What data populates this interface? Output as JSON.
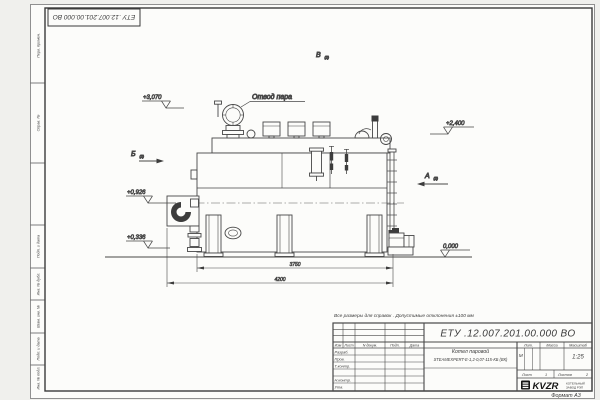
{
  "sheet": {
    "stamp_top_left": "ЕТУ .12.007.201.00.000  ВО",
    "margin_labels": [
      "Перв. примен.",
      "Справ. №",
      "Подп. и дата",
      "Инв. № дубл.",
      "Взам. инв. №",
      "Подп. и дата",
      "Инв. № подл."
    ],
    "format_label": "Формат А3"
  },
  "drawing": {
    "callout_steam": "Отвод пара",
    "views": [
      {
        "letter": "Б",
        "ref": "(2)"
      },
      {
        "letter": "В",
        "ref": "(2)"
      },
      {
        "letter": "А",
        "ref": "(2)"
      }
    ],
    "elevations": [
      "+3,070",
      "+2,400",
      "+0,926",
      "+0,336",
      "0,000"
    ],
    "dims": [
      "3750",
      "4200"
    ]
  },
  "note": "Все размеры для справок . Допустимые отклонения  ±100 мм",
  "title_block": {
    "number": "ЕТУ .12.007.201.00.000  ВО",
    "header_cols": [
      "Изм",
      "Лист",
      "N докум.",
      "Подп.",
      "Дата"
    ],
    "roles": [
      "Разраб.",
      "Пров.",
      "Т.контр.",
      "Н.контр.",
      "Утв."
    ],
    "name_line1": "Котел паровой",
    "name_line2": "STEAMEXPERT-Е-1,2-0,07-115-КБ (ВК)",
    "lit_label": "Лит.",
    "mass_label": "Масса",
    "scale_label": "Масштаб",
    "lit_value": "М",
    "scale_value": "1:25",
    "sheet_label": "Лист",
    "sheet_no": "1",
    "sheets_label": "Листов",
    "sheets_total": "2",
    "logo_text": "KVZR",
    "company_line1": "КОТЕЛЬНЫЙ",
    "company_line2": "ЗАВОД РЭП"
  }
}
